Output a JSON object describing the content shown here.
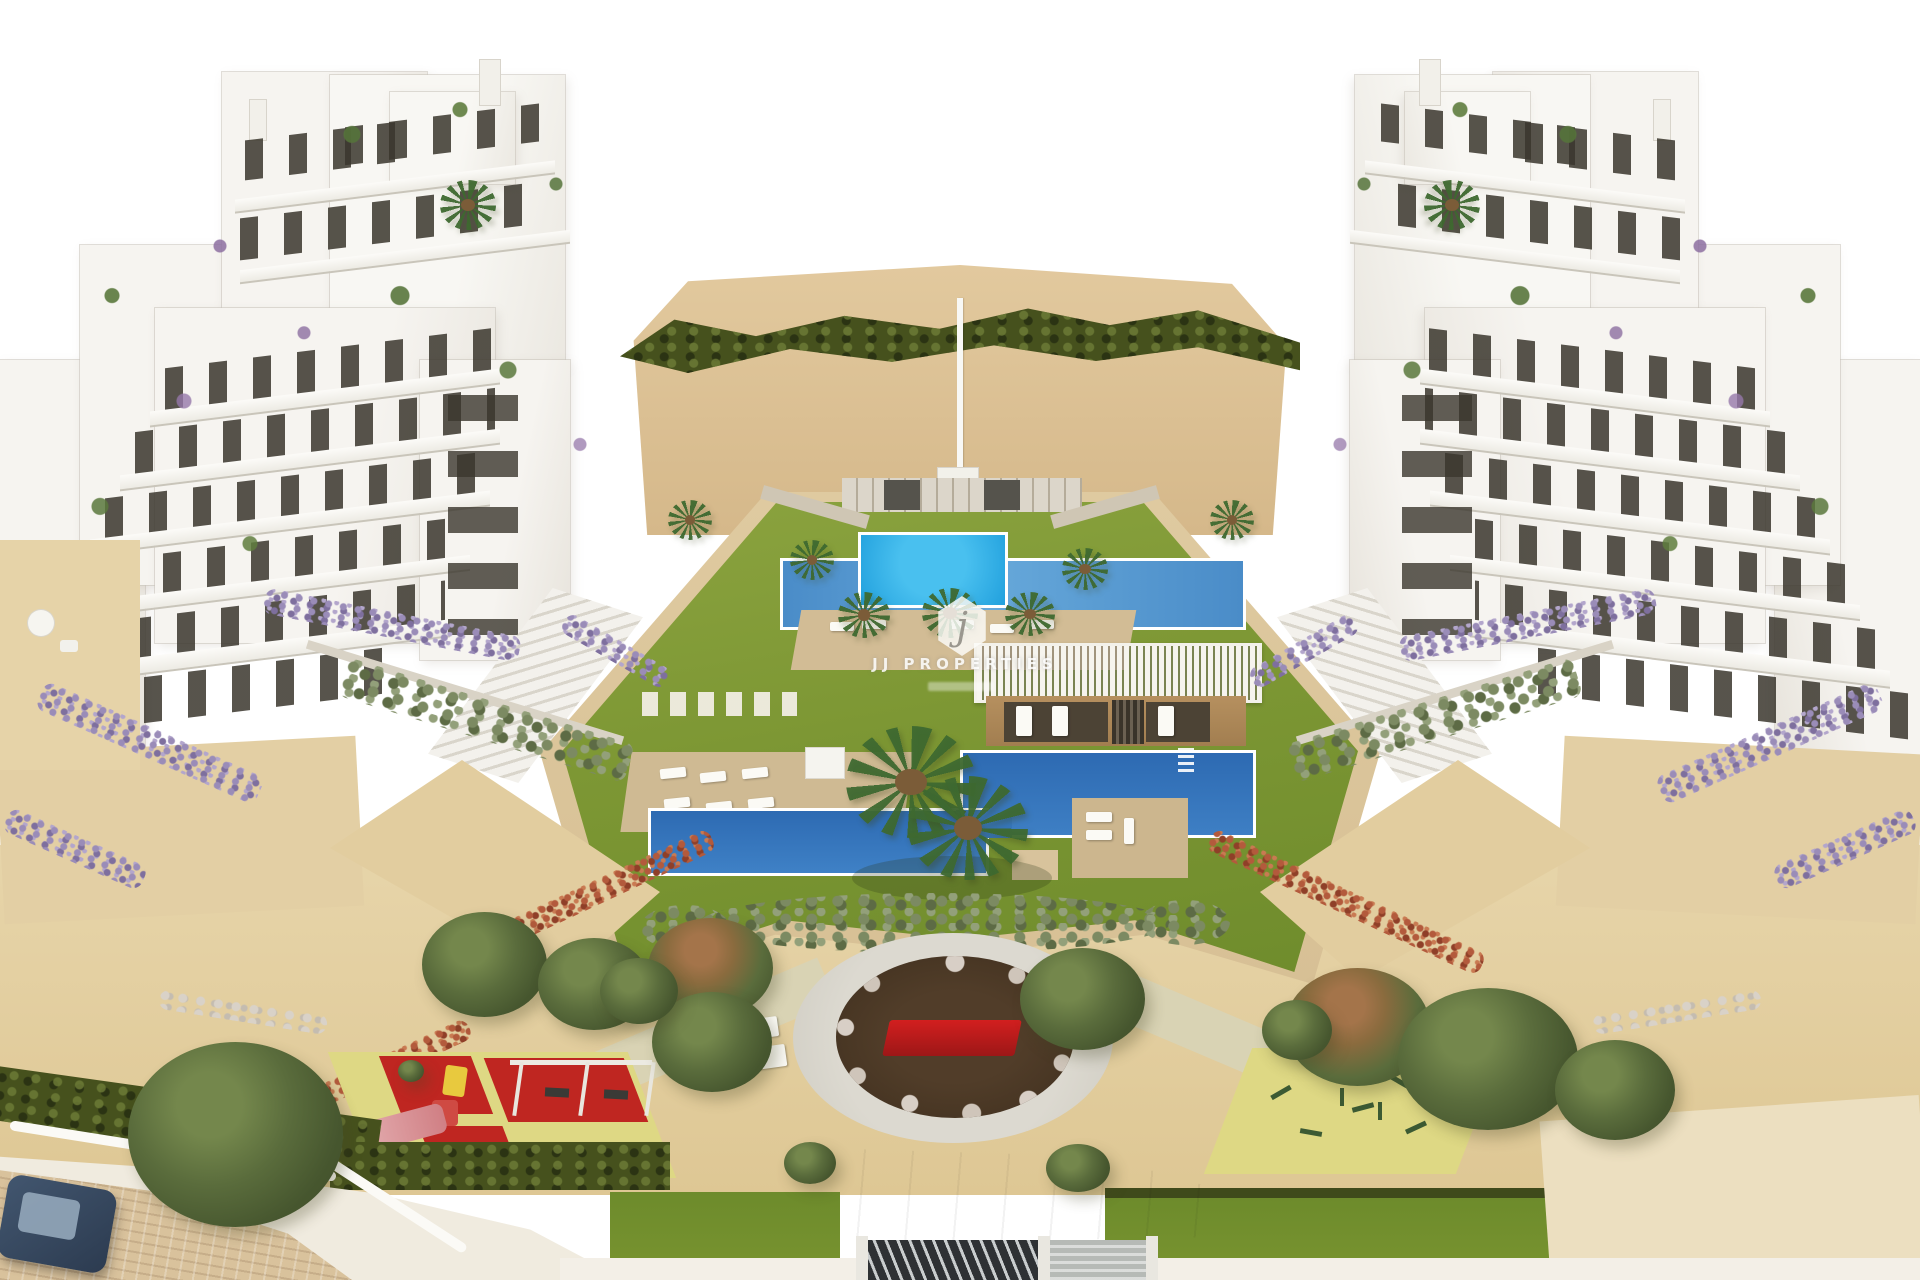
{
  "image": {
    "type": "architectural-aerial-render",
    "description": "Aerial 3D render of a white Mediterranean apartment complex: two building clusters flank a landscaped courtyard with a kids pool, a lap pool, a large L-shaped swimming pool, pergola pool house and sun decks; below are sandy gardens with a children's playground, a calisthenics area, a circular plaza with a red bench, olive and palm trees, an entrance gate and an access road with a parked car."
  },
  "watermark": {
    "logo_letter": "j",
    "brand_text": "JJ PROPERTIES"
  },
  "palette": {
    "sky": "#ffffff",
    "building_white": "#f6f4f0",
    "window_dark": "#3a362d",
    "sand_hill": "#dcc094",
    "sand_park": "#e4d1a6",
    "lawn": "#7d9734",
    "hedge_dark": "#46511d",
    "pool_dark": "#2d6ab2",
    "pool_mid": "#4a8cc8",
    "pool_bright": "#2aa7e2",
    "deck_tan": "#d2bc95",
    "pergola_tan": "#ab8a61",
    "red_mat": "#bf2621",
    "yellow_mat": "#ded884",
    "plaza_ring": "#d8d5cc",
    "plaza_soil": "#4a3626",
    "bench_red": "#c2201d",
    "hedge_red": "#a85136",
    "lavender": "#9187ad",
    "olive_green": "#57683a",
    "car_blue": "#36475f"
  },
  "scene": {
    "elements": [
      "left apartment cluster",
      "right apartment cluster",
      "sand hill with hedge",
      "flag pole",
      "kids pool",
      "lap pool",
      "main pool",
      "pool deck island",
      "pergola pool house",
      "sun deck with loungers",
      "courtyard lawn",
      "circular plaza",
      "red bench",
      "children playground",
      "swing set",
      "slide",
      "calisthenics area",
      "entrance gate",
      "access road",
      "parked car",
      "olive trees",
      "palm trees",
      "lavender hedges",
      "red flowering hedges"
    ]
  }
}
